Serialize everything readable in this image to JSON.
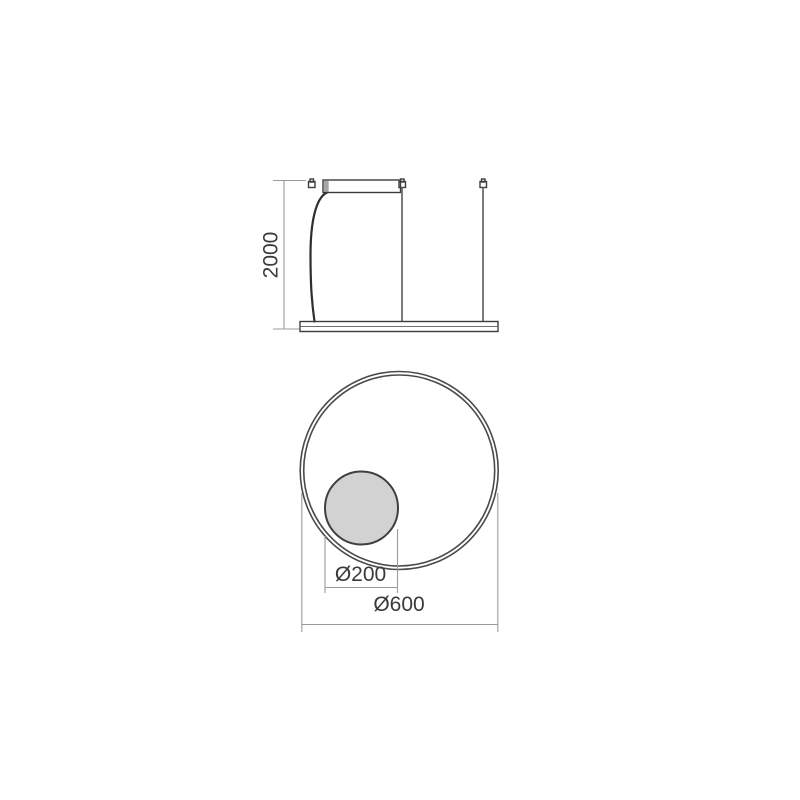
{
  "page": {
    "background_color": "#ffffff"
  },
  "drawing": {
    "title": "Circular ring pendant lamp - dimensioned technical drawing",
    "colors": {
      "outline": "#3c3c3c",
      "ring_line": "#4a4a4a",
      "dimension_line": "#9b9b9b",
      "text": "#3a3a3a",
      "canopy_fill": "#d9d9d9",
      "canopy_edge_fill": "#a6a6a6",
      "bar_fill": "#c6c6c6",
      "bar_stripe_fill": "#ffffff",
      "sphere_fill": "#d2d2d2",
      "bracket_fill": "#ffffff"
    },
    "side_view": {
      "height_dimension": {
        "label": "2000",
        "value_mm": 2000,
        "orientation": "vertical"
      }
    },
    "front_view": {
      "sphere_dimension": {
        "label": "Ø200",
        "value_mm": 200
      },
      "ring_dimension": {
        "label": "Ø600",
        "value_mm": 600
      }
    }
  }
}
